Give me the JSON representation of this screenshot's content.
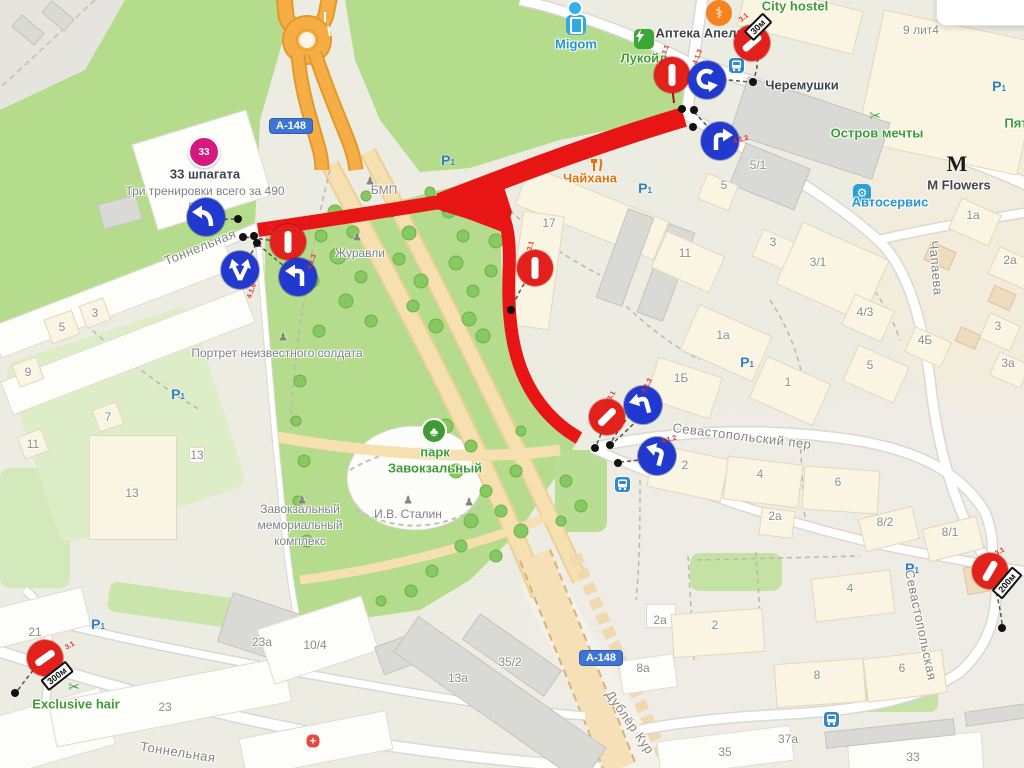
{
  "colors": {
    "poi_green": "#3f9c35",
    "poi_blue": "#2596d1",
    "poi_orange": "#e8710a",
    "poi_dark": "#40454d",
    "gray": "#82827a",
    "bldg_gray": "#8d8d85",
    "route_red": "#e81515",
    "sign_red": "#e3211c",
    "sign_blue": "#2139cf",
    "road_orange": "#f7ad45",
    "park_green": "#b4dc8c"
  },
  "shields": [
    {
      "text": "А-148",
      "x": 291,
      "y": 126
    },
    {
      "text": "А-148",
      "x": 601,
      "y": 658
    }
  ],
  "streets": [
    {
      "text": "Тоннельная",
      "x": 200,
      "y": 247,
      "rot": -22
    },
    {
      "text": "Тоннельная",
      "x": 178,
      "y": 752,
      "rot": 9
    },
    {
      "text": "Севастопольский пер",
      "x": 742,
      "y": 436,
      "rot": 7
    },
    {
      "text": "Севастопольская",
      "x": 921,
      "y": 625,
      "rot": 78
    },
    {
      "text": "Чапаева",
      "x": 936,
      "y": 268,
      "rot": 85
    },
    {
      "text": "Дублёр Кур",
      "x": 630,
      "y": 722,
      "rot": 55
    }
  ],
  "pois": [
    {
      "text": "City hostel",
      "x": 795,
      "y": 6,
      "c": "poi_green"
    },
    {
      "text": "Аптека Апель",
      "x": 700,
      "y": 33,
      "c": "poi_dark"
    },
    {
      "text": "Migom",
      "x": 576,
      "y": 44,
      "c": "poi_blue"
    },
    {
      "text": "Лукойл",
      "x": 644,
      "y": 58,
      "c": "poi_green"
    },
    {
      "text": "Черемушки",
      "x": 802,
      "y": 85,
      "c": "poi_dark"
    },
    {
      "text": "Остров мечты",
      "x": 877,
      "y": 133,
      "c": "poi_green"
    },
    {
      "text": "Пят",
      "x": 1016,
      "y": 123,
      "c": "poi_green"
    },
    {
      "text": "M Flowers",
      "x": 959,
      "y": 185,
      "c": "poi_dark"
    },
    {
      "text": "Автосервис",
      "x": 890,
      "y": 202,
      "c": "poi_blue"
    },
    {
      "text": "Чайхана",
      "x": 590,
      "y": 178,
      "c": "poi_orange"
    },
    {
      "text": "33 шпагата",
      "x": 205,
      "y": 174,
      "c": "poi_dark"
    },
    {
      "text": "Exclusive hair",
      "x": 76,
      "y": 704,
      "c": "poi_green"
    },
    {
      "text": "парк",
      "x": 435,
      "y": 452,
      "c": "poi_green"
    },
    {
      "text": "Завокзальный",
      "x": 435,
      "y": 468,
      "c": "poi_green"
    }
  ],
  "subtexts": [
    {
      "text": "Три тренировки всего за 490",
      "x": 205,
      "y": 191
    },
    {
      "text": "руб.",
      "x": 200,
      "y": 205
    },
    {
      "text": "Журавли",
      "x": 360,
      "y": 253
    },
    {
      "text": "БМП",
      "x": 384,
      "y": 190
    },
    {
      "text": "Портрет неизвестного солдата",
      "x": 277,
      "y": 353
    },
    {
      "text": "Завокзальный",
      "x": 300,
      "y": 509
    },
    {
      "text": "мемориальный",
      "x": 300,
      "y": 525
    },
    {
      "text": "комплекс",
      "x": 300,
      "y": 541
    },
    {
      "text": "И.В. Сталин",
      "x": 408,
      "y": 514
    }
  ],
  "buildings": [
    {
      "text": "5",
      "x": 62,
      "y": 327
    },
    {
      "text": "3",
      "x": 95,
      "y": 313
    },
    {
      "text": "9",
      "x": 28,
      "y": 372
    },
    {
      "text": "7",
      "x": 108,
      "y": 417
    },
    {
      "text": "11",
      "x": 33,
      "y": 444
    },
    {
      "text": "13",
      "x": 197,
      "y": 455
    },
    {
      "text": "13",
      "x": 132,
      "y": 493
    },
    {
      "text": "21",
      "x": 35,
      "y": 632
    },
    {
      "text": "23",
      "x": 165,
      "y": 707
    },
    {
      "text": "23а",
      "x": 262,
      "y": 642
    },
    {
      "text": "10/4",
      "x": 315,
      "y": 645
    },
    {
      "text": "13а",
      "x": 458,
      "y": 678
    },
    {
      "text": "35/2",
      "x": 510,
      "y": 662
    },
    {
      "text": "8а",
      "x": 643,
      "y": 668
    },
    {
      "text": "2а",
      "x": 660,
      "y": 620
    },
    {
      "text": "35",
      "x": 725,
      "y": 752
    },
    {
      "text": "33",
      "x": 913,
      "y": 757
    },
    {
      "text": "37а",
      "x": 788,
      "y": 739
    },
    {
      "text": "9 лит4",
      "x": 921,
      "y": 30
    },
    {
      "text": "5/1",
      "x": 758,
      "y": 165
    },
    {
      "text": "5",
      "x": 724,
      "y": 185
    },
    {
      "text": "17",
      "x": 549,
      "y": 223
    },
    {
      "text": "11",
      "x": 685,
      "y": 253
    },
    {
      "text": "3",
      "x": 773,
      "y": 242
    },
    {
      "text": "3/1",
      "x": 818,
      "y": 262
    },
    {
      "text": "1а",
      "x": 973,
      "y": 215
    },
    {
      "text": "2а",
      "x": 1010,
      "y": 260
    },
    {
      "text": "3",
      "x": 998,
      "y": 326
    },
    {
      "text": "3а",
      "x": 1008,
      "y": 363
    },
    {
      "text": "4/3",
      "x": 865,
      "y": 312
    },
    {
      "text": "4Б",
      "x": 925,
      "y": 340
    },
    {
      "text": "5",
      "x": 870,
      "y": 365
    },
    {
      "text": "1",
      "x": 788,
      "y": 382
    },
    {
      "text": "1а",
      "x": 723,
      "y": 335
    },
    {
      "text": "1Б",
      "x": 681,
      "y": 378
    },
    {
      "text": "2",
      "x": 685,
      "y": 465
    },
    {
      "text": "4",
      "x": 760,
      "y": 474
    },
    {
      "text": "6",
      "x": 838,
      "y": 482
    },
    {
      "text": "2а",
      "x": 775,
      "y": 516
    },
    {
      "text": "8/2",
      "x": 885,
      "y": 522
    },
    {
      "text": "8/1",
      "x": 950,
      "y": 532
    },
    {
      "text": "4",
      "x": 850,
      "y": 588
    },
    {
      "text": "2",
      "x": 715,
      "y": 625
    },
    {
      "text": "8",
      "x": 817,
      "y": 675
    },
    {
      "text": "6",
      "x": 902,
      "y": 668
    }
  ],
  "bshapes": [
    {
      "x": 120,
      "y": 212,
      "w": 40,
      "h": 26,
      "r": -15,
      "f": "g"
    },
    {
      "x": 202,
      "y": 170,
      "w": 120,
      "h": 90,
      "r": -17,
      "f": "w"
    },
    {
      "x": 112,
      "y": 298,
      "w": 250,
      "h": 34,
      "r": -21,
      "f": "w"
    },
    {
      "x": 128,
      "y": 352,
      "w": 260,
      "h": 36,
      "r": -21,
      "f": "w"
    },
    {
      "x": 62,
      "y": 327,
      "w": 30,
      "h": 26,
      "r": -20,
      "f": "c"
    },
    {
      "x": 95,
      "y": 313,
      "w": 26,
      "h": 24,
      "r": -20,
      "f": "c"
    },
    {
      "x": 28,
      "y": 372,
      "w": 26,
      "h": 24,
      "r": -20,
      "f": "c"
    },
    {
      "x": 108,
      "y": 417,
      "w": 26,
      "h": 24,
      "r": -20,
      "f": "c"
    },
    {
      "x": 33,
      "y": 444,
      "w": 26,
      "h": 24,
      "r": -20,
      "f": "c"
    },
    {
      "x": 133,
      "y": 487,
      "w": 88,
      "h": 105,
      "r": 0,
      "f": "c"
    },
    {
      "x": 197,
      "y": 455,
      "w": 16,
      "h": 16,
      "r": 0,
      "f": "w"
    },
    {
      "x": 50,
      "y": 732,
      "w": 120,
      "h": 60,
      "r": -16,
      "f": "w"
    },
    {
      "x": 38,
      "y": 618,
      "w": 100,
      "h": 40,
      "r": -14,
      "f": "w"
    },
    {
      "x": 170,
      "y": 702,
      "w": 240,
      "h": 46,
      "r": -11,
      "f": "w"
    },
    {
      "x": 265,
      "y": 630,
      "w": 85,
      "h": 52,
      "r": 18,
      "f": "g"
    },
    {
      "x": 318,
      "y": 640,
      "w": 110,
      "h": 58,
      "r": -18,
      "f": "w"
    },
    {
      "x": 396,
      "y": 655,
      "w": 36,
      "h": 30,
      "r": -20,
      "f": "g"
    },
    {
      "x": 500,
      "y": 700,
      "w": 230,
      "h": 44,
      "r": 35,
      "f": "g"
    },
    {
      "x": 512,
      "y": 655,
      "w": 100,
      "h": 32,
      "r": 35,
      "f": "g"
    },
    {
      "x": 648,
      "y": 674,
      "w": 56,
      "h": 34,
      "r": -8,
      "f": "w"
    },
    {
      "x": 661,
      "y": 616,
      "w": 30,
      "h": 24,
      "r": 0,
      "f": "w"
    },
    {
      "x": 316,
      "y": 744,
      "w": 150,
      "h": 40,
      "r": -11,
      "f": "w"
    },
    {
      "x": 725,
      "y": 751,
      "w": 135,
      "h": 36,
      "r": -7,
      "f": "w"
    },
    {
      "x": 915,
      "y": 755,
      "w": 135,
      "h": 38,
      "r": -4,
      "f": "w"
    },
    {
      "x": 890,
      "y": 733,
      "w": 130,
      "h": 17,
      "r": -6,
      "f": "g"
    },
    {
      "x": 1000,
      "y": 714,
      "w": 70,
      "h": 15,
      "r": -8,
      "f": "g"
    },
    {
      "x": 800,
      "y": 18,
      "w": 120,
      "h": 45,
      "r": 14,
      "f": "c"
    },
    {
      "x": 950,
      "y": 92,
      "w": 165,
      "h": 135,
      "r": 12,
      "f": "c"
    },
    {
      "x": 810,
      "y": 128,
      "w": 150,
      "h": 60,
      "r": 18,
      "f": "g"
    },
    {
      "x": 770,
      "y": 176,
      "w": 70,
      "h": 45,
      "r": 22,
      "f": "g"
    },
    {
      "x": 718,
      "y": 192,
      "w": 34,
      "h": 28,
      "r": 22,
      "f": "c"
    },
    {
      "x": 592,
      "y": 213,
      "w": 150,
      "h": 42,
      "r": 22,
      "f": "c"
    },
    {
      "x": 536,
      "y": 270,
      "w": 42,
      "h": 115,
      "r": 8,
      "f": "c"
    },
    {
      "x": 625,
      "y": 257,
      "w": 28,
      "h": 95,
      "r": 20,
      "f": "g"
    },
    {
      "x": 666,
      "y": 272,
      "w": 28,
      "h": 95,
      "r": 20,
      "f": "g"
    },
    {
      "x": 688,
      "y": 262,
      "w": 64,
      "h": 40,
      "r": 24,
      "f": "c"
    },
    {
      "x": 775,
      "y": 250,
      "w": 38,
      "h": 30,
      "r": 24,
      "f": "c"
    },
    {
      "x": 832,
      "y": 272,
      "w": 95,
      "h": 68,
      "r": 24,
      "f": "c"
    },
    {
      "x": 975,
      "y": 222,
      "w": 44,
      "h": 34,
      "r": 24,
      "f": "c"
    },
    {
      "x": 1012,
      "y": 268,
      "w": 40,
      "h": 30,
      "r": 24,
      "f": "c"
    },
    {
      "x": 1000,
      "y": 332,
      "w": 34,
      "h": 28,
      "r": 24,
      "f": "c"
    },
    {
      "x": 1010,
      "y": 370,
      "w": 34,
      "h": 26,
      "r": 24,
      "f": "c"
    },
    {
      "x": 868,
      "y": 318,
      "w": 44,
      "h": 34,
      "r": 24,
      "f": "c"
    },
    {
      "x": 928,
      "y": 347,
      "w": 40,
      "h": 28,
      "r": 24,
      "f": "c"
    },
    {
      "x": 876,
      "y": 374,
      "w": 56,
      "h": 40,
      "r": 24,
      "f": "c"
    },
    {
      "x": 790,
      "y": 391,
      "w": 70,
      "h": 46,
      "r": 24,
      "f": "c"
    },
    {
      "x": 726,
      "y": 343,
      "w": 80,
      "h": 50,
      "r": 24,
      "f": "c"
    },
    {
      "x": 684,
      "y": 388,
      "w": 68,
      "h": 44,
      "r": 18,
      "f": "c"
    },
    {
      "x": 688,
      "y": 473,
      "w": 76,
      "h": 44,
      "r": 12,
      "f": "c"
    },
    {
      "x": 763,
      "y": 482,
      "w": 76,
      "h": 44,
      "r": 7,
      "f": "c"
    },
    {
      "x": 841,
      "y": 490,
      "w": 76,
      "h": 44,
      "r": 4,
      "f": "c"
    },
    {
      "x": 777,
      "y": 523,
      "w": 34,
      "h": 28,
      "r": 7,
      "f": "c"
    },
    {
      "x": 889,
      "y": 529,
      "w": 56,
      "h": 34,
      "r": -14,
      "f": "c"
    },
    {
      "x": 953,
      "y": 539,
      "w": 56,
      "h": 34,
      "r": -14,
      "f": "c"
    },
    {
      "x": 853,
      "y": 596,
      "w": 80,
      "h": 44,
      "r": -7,
      "f": "c"
    },
    {
      "x": 718,
      "y": 633,
      "w": 92,
      "h": 44,
      "r": -4,
      "f": "c"
    },
    {
      "x": 820,
      "y": 683,
      "w": 90,
      "h": 44,
      "r": -4,
      "f": "c"
    },
    {
      "x": 905,
      "y": 676,
      "w": 80,
      "h": 44,
      "r": -7,
      "f": "c"
    },
    {
      "x": 985,
      "y": 578,
      "w": 40,
      "h": 28,
      "r": -10,
      "f": "t"
    },
    {
      "x": 940,
      "y": 256,
      "w": 28,
      "h": 20,
      "r": 24,
      "f": "t"
    },
    {
      "x": 1002,
      "y": 298,
      "w": 24,
      "h": 18,
      "r": 24,
      "f": "t"
    },
    {
      "x": 968,
      "y": 338,
      "w": 22,
      "h": 16,
      "r": 24,
      "f": "t"
    },
    {
      "x": 28,
      "y": 30,
      "w": 30,
      "h": 16,
      "r": 40,
      "f": "g"
    },
    {
      "x": 58,
      "y": 16,
      "w": 30,
      "h": 16,
      "r": 40,
      "f": "g"
    }
  ],
  "signs": [
    {
      "kind": "noentry",
      "x": 288,
      "y": 242,
      "rot": 90
    },
    {
      "kind": "noentry",
      "x": 672,
      "y": 75,
      "rot": 90
    },
    {
      "kind": "noentry",
      "x": 752,
      "y": 43,
      "rot": -40
    },
    {
      "kind": "noentry",
      "x": 535,
      "y": 268,
      "rot": 90
    },
    {
      "kind": "noentry",
      "x": 607,
      "y": 417,
      "rot": -45
    },
    {
      "kind": "noentry",
      "x": 45,
      "y": 658,
      "rot": -35
    },
    {
      "kind": "noentry",
      "x": 990,
      "y": 571,
      "rot": -60
    },
    {
      "kind": "jcurve",
      "x": 206,
      "y": 217,
      "rot": 0
    },
    {
      "kind": "fork2",
      "x": 240,
      "y": 270,
      "rot": 0
    },
    {
      "kind": "left",
      "x": 298,
      "y": 277,
      "rot": 0
    },
    {
      "kind": "uturn",
      "x": 707,
      "y": 80,
      "rot": 0
    },
    {
      "kind": "right",
      "x": 720,
      "y": 141,
      "rot": 0
    },
    {
      "kind": "left",
      "x": 643,
      "y": 405,
      "rot": -15
    },
    {
      "kind": "left",
      "x": 657,
      "y": 456,
      "rot": 15
    }
  ],
  "plaques": [
    {
      "text": "30м",
      "x": 758,
      "y": 27,
      "rot": -45
    },
    {
      "text": "300м",
      "x": 57,
      "y": 676,
      "rot": -38
    },
    {
      "text": "200м",
      "x": 1007,
      "y": 583,
      "rot": -50
    }
  ],
  "codes": [
    {
      "text": "3.1",
      "x": 272,
      "y": 229,
      "rot": -70
    },
    {
      "text": "4.1.6",
      "x": 252,
      "y": 291,
      "rot": -70
    },
    {
      "text": "4.1.3",
      "x": 312,
      "y": 262,
      "rot": -70
    },
    {
      "text": "3.1",
      "x": 666,
      "y": 50,
      "rot": -70
    },
    {
      "text": "4.1.3",
      "x": 698,
      "y": 57,
      "rot": -70
    },
    {
      "text": "3.1",
      "x": 744,
      "y": 18,
      "rot": -40
    },
    {
      "text": "4.1.2",
      "x": 741,
      "y": 140,
      "rot": -15
    },
    {
      "text": "3.1",
      "x": 531,
      "y": 246,
      "rot": -75
    },
    {
      "text": "3.1",
      "x": 612,
      "y": 396,
      "rot": -60
    },
    {
      "text": "4.1.3",
      "x": 647,
      "y": 386,
      "rot": -60
    },
    {
      "text": "4.1.2",
      "x": 669,
      "y": 440,
      "rot": -15
    },
    {
      "text": "3.1",
      "x": 70,
      "y": 646,
      "rot": -30
    },
    {
      "text": "3.1",
      "x": 1000,
      "y": 552,
      "rot": -30
    }
  ],
  "dots": [
    {
      "x": 238,
      "y": 219
    },
    {
      "x": 243,
      "y": 237
    },
    {
      "x": 254,
      "y": 236
    },
    {
      "x": 257,
      "y": 243
    },
    {
      "x": 682,
      "y": 109
    },
    {
      "x": 694,
      "y": 110
    },
    {
      "x": 693,
      "y": 127
    },
    {
      "x": 753,
      "y": 82
    },
    {
      "x": 511,
      "y": 310
    },
    {
      "x": 595,
      "y": 448
    },
    {
      "x": 610,
      "y": 445
    },
    {
      "x": 618,
      "y": 463
    },
    {
      "x": 15,
      "y": 693
    },
    {
      "x": 1002,
      "y": 628
    }
  ],
  "parking": [
    {
      "x": 448,
      "y": 160
    },
    {
      "x": 645,
      "y": 188
    },
    {
      "x": 999,
      "y": 86
    },
    {
      "x": 912,
      "y": 568
    },
    {
      "x": 98,
      "y": 624
    },
    {
      "x": 178,
      "y": 394
    },
    {
      "x": 747,
      "y": 362
    }
  ],
  "bus_stops": [
    {
      "x": 728,
      "y": 57
    },
    {
      "x": 614,
      "y": 476
    },
    {
      "x": 823,
      "y": 711
    }
  ],
  "icons": [
    {
      "kind": "pharmacy",
      "x": 719,
      "y": 13
    },
    {
      "kind": "migom",
      "x": 576,
      "y": 25
    },
    {
      "kind": "lukoil",
      "x": 644,
      "y": 39
    },
    {
      "kind": "scissors",
      "x": 875,
      "y": 116
    },
    {
      "kind": "scissors",
      "x": 74,
      "y": 687
    },
    {
      "kind": "mlogo",
      "x": 957,
      "y": 164
    },
    {
      "kind": "gear",
      "x": 862,
      "y": 193
    },
    {
      "kind": "fork-knife",
      "x": 590,
      "y": 158
    },
    {
      "kind": "pink33",
      "x": 204,
      "y": 152
    },
    {
      "kind": "tree",
      "x": 434,
      "y": 431
    },
    {
      "kind": "statue",
      "x": 357,
      "y": 237
    },
    {
      "kind": "statue",
      "x": 370,
      "y": 181
    },
    {
      "kind": "statue",
      "x": 283,
      "y": 337
    },
    {
      "kind": "statue",
      "x": 302,
      "y": 500
    },
    {
      "kind": "statue",
      "x": 408,
      "y": 500
    },
    {
      "kind": "statue",
      "x": 469,
      "y": 502
    },
    {
      "kind": "bluedot",
      "x": 575,
      "y": 8
    },
    {
      "kind": "medcross",
      "x": 313,
      "y": 741
    }
  ],
  "pink_badge_text": "33"
}
